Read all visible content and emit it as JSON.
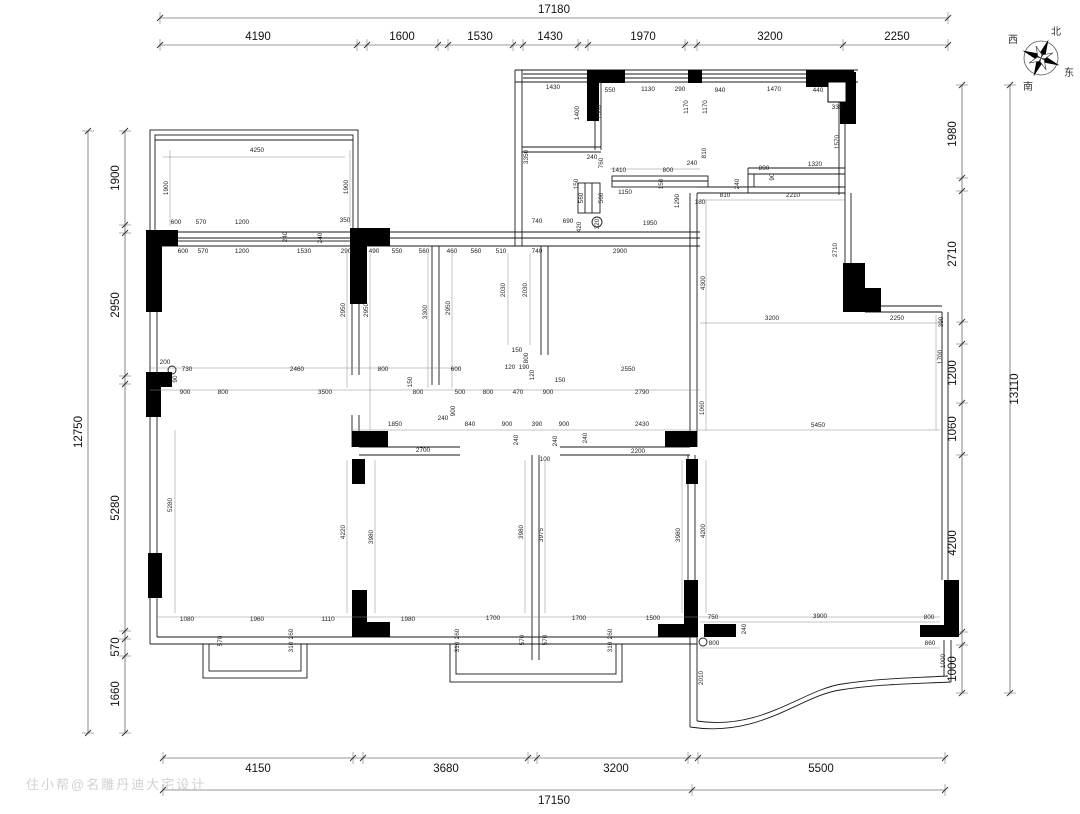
{
  "watermark": "住小帮@名雕丹迪大宅设计",
  "compass": {
    "north": "北",
    "south": "南",
    "east": "东",
    "west": "西"
  },
  "colors": {
    "wall": "#1a1a1a",
    "dim": "#333333",
    "thin": "#888888",
    "watermark": "#c9c9c9"
  },
  "dim_chains": [
    {
      "name": "top-total",
      "dir": "h",
      "y": 18,
      "ticks": [
        160,
        948
      ],
      "label_dy": -5,
      "labels": [
        {
          "p": 554,
          "t": "17180"
        }
      ]
    },
    {
      "name": "top-segments",
      "dir": "h",
      "y": 45,
      "ticks": [
        160,
        357,
        367,
        438,
        448,
        513,
        523,
        578,
        588,
        685,
        697,
        843,
        948
      ],
      "label_dy": -5,
      "labels": [
        {
          "p": 258,
          "t": "4190"
        },
        {
          "p": 402,
          "t": "1600"
        },
        {
          "p": 480,
          "t": "1530"
        },
        {
          "p": 550,
          "t": "1430"
        },
        {
          "p": 643,
          "t": "1970"
        },
        {
          "p": 770,
          "t": "3200"
        },
        {
          "p": 897,
          "t": "2250"
        }
      ]
    },
    {
      "name": "bottom-segments",
      "dir": "h",
      "y": 758,
      "ticks": [
        163,
        353,
        363,
        528,
        537,
        688,
        698,
        945
      ],
      "label_dy": 14,
      "labels": [
        {
          "p": 258,
          "t": "4150"
        },
        {
          "p": 446,
          "t": "3680"
        },
        {
          "p": 616,
          "t": "3200"
        },
        {
          "p": 821,
          "t": "5500"
        }
      ]
    },
    {
      "name": "bottom-total",
      "dir": "h",
      "y": 790,
      "ticks": [
        163,
        692,
        945
      ],
      "label_dy": 14,
      "labels": [
        {
          "p": 554,
          "t": "17150"
        }
      ]
    },
    {
      "name": "left-total",
      "dir": "v",
      "x": 88,
      "ticks": [
        131,
        733
      ],
      "label_dx": -6,
      "labels": [
        {
          "p": 432,
          "t": "12750"
        }
      ]
    },
    {
      "name": "left-segments",
      "dir": "v",
      "x": 125,
      "ticks": [
        131,
        225,
        233,
        376,
        384,
        631,
        639,
        656,
        733
      ],
      "label_dx": -6,
      "labels": [
        {
          "p": 178,
          "t": "1900"
        },
        {
          "p": 305,
          "t": "2950"
        },
        {
          "p": 508,
          "t": "5280"
        },
        {
          "p": 647,
          "t": "570"
        },
        {
          "p": 694,
          "t": "1660"
        }
      ]
    },
    {
      "name": "right-segments",
      "dir": "v",
      "x": 962,
      "ticks": [
        85,
        178,
        191,
        322,
        344,
        403,
        455,
        632,
        645,
        693
      ],
      "label_dx": -6,
      "labels": [
        {
          "p": 134,
          "t": "1980"
        },
        {
          "p": 254,
          "t": "2710"
        },
        {
          "p": 373,
          "t": "1200"
        },
        {
          "p": 429,
          "t": "1060"
        },
        {
          "p": 543,
          "t": "4200"
        },
        {
          "p": 669,
          "t": "1000"
        }
      ]
    },
    {
      "name": "right-total",
      "dir": "v",
      "x": 1010,
      "ticks": [
        85,
        693
      ],
      "label_dx": 8,
      "labels": [
        {
          "p": 389,
          "t": "13110"
        }
      ]
    }
  ],
  "annotations": [
    {
      "x": 257,
      "y": 152,
      "t": "4250"
    },
    {
      "x": 168,
      "y": 188,
      "t": "1900",
      "r": 1
    },
    {
      "x": 348,
      "y": 187,
      "t": "1900",
      "r": 1
    },
    {
      "x": 176,
      "y": 224,
      "t": "600"
    },
    {
      "x": 201,
      "y": 224,
      "t": "570"
    },
    {
      "x": 242,
      "y": 224,
      "t": "1200"
    },
    {
      "x": 345,
      "y": 222,
      "t": "350"
    },
    {
      "x": 287,
      "y": 237,
      "t": "240",
      "r": 1
    },
    {
      "x": 322,
      "y": 238,
      "t": "240",
      "r": 1
    },
    {
      "x": 183,
      "y": 253,
      "t": "600"
    },
    {
      "x": 203,
      "y": 253,
      "t": "570"
    },
    {
      "x": 242,
      "y": 253,
      "t": "1200"
    },
    {
      "x": 304,
      "y": 253,
      "t": "1530"
    },
    {
      "x": 346,
      "y": 253,
      "t": "290"
    },
    {
      "x": 374,
      "y": 253,
      "t": "490"
    },
    {
      "x": 397,
      "y": 253,
      "t": "550"
    },
    {
      "x": 424,
      "y": 253,
      "t": "560"
    },
    {
      "x": 452,
      "y": 253,
      "t": "460"
    },
    {
      "x": 476,
      "y": 253,
      "t": "560"
    },
    {
      "x": 501,
      "y": 253,
      "t": "510"
    },
    {
      "x": 537,
      "y": 253,
      "t": "740"
    },
    {
      "x": 620,
      "y": 253,
      "t": "2900"
    },
    {
      "x": 537,
      "y": 223,
      "t": "740"
    },
    {
      "x": 568,
      "y": 223,
      "t": "690"
    },
    {
      "x": 581,
      "y": 227,
      "t": "420",
      "r": 1
    },
    {
      "x": 599,
      "y": 224,
      "t": "320",
      "r": 1
    },
    {
      "x": 650,
      "y": 225,
      "t": "1950"
    },
    {
      "x": 345,
      "y": 310,
      "t": "2950",
      "r": 1
    },
    {
      "x": 368,
      "y": 310,
      "t": "2950",
      "r": 1
    },
    {
      "x": 427,
      "y": 312,
      "t": "3300",
      "r": 1
    },
    {
      "x": 450,
      "y": 308,
      "t": "2950",
      "r": 1
    },
    {
      "x": 505,
      "y": 290,
      "t": "2030",
      "r": 1
    },
    {
      "x": 527,
      "y": 290,
      "t": "2030",
      "r": 1
    },
    {
      "x": 165,
      "y": 364,
      "t": "200"
    },
    {
      "x": 187,
      "y": 371,
      "t": "730"
    },
    {
      "x": 177,
      "y": 379,
      "t": "90",
      "r": 1
    },
    {
      "x": 297,
      "y": 371,
      "t": "2460"
    },
    {
      "x": 383,
      "y": 371,
      "t": "800"
    },
    {
      "x": 412,
      "y": 382,
      "t": "150",
      "r": 1
    },
    {
      "x": 456,
      "y": 371,
      "t": "600"
    },
    {
      "x": 517,
      "y": 352,
      "t": "150"
    },
    {
      "x": 528,
      "y": 358,
      "t": "800",
      "r": 1
    },
    {
      "x": 510,
      "y": 369,
      "t": "120"
    },
    {
      "x": 524,
      "y": 369,
      "t": "190"
    },
    {
      "x": 534,
      "y": 375,
      "t": "120",
      "r": 1
    },
    {
      "x": 560,
      "y": 382,
      "t": "150"
    },
    {
      "x": 628,
      "y": 371,
      "t": "2550"
    },
    {
      "x": 185,
      "y": 394,
      "t": "900"
    },
    {
      "x": 223,
      "y": 394,
      "t": "800"
    },
    {
      "x": 325,
      "y": 394,
      "t": "3500"
    },
    {
      "x": 418,
      "y": 394,
      "t": "800"
    },
    {
      "x": 460,
      "y": 394,
      "t": "500"
    },
    {
      "x": 488,
      "y": 394,
      "t": "800"
    },
    {
      "x": 518,
      "y": 394,
      "t": "470"
    },
    {
      "x": 548,
      "y": 394,
      "t": "900"
    },
    {
      "x": 642,
      "y": 394,
      "t": "2790"
    },
    {
      "x": 455,
      "y": 411,
      "t": "900",
      "r": 1
    },
    {
      "x": 704,
      "y": 408,
      "t": "1060",
      "r": 1
    },
    {
      "x": 395,
      "y": 426,
      "t": "1850"
    },
    {
      "x": 443,
      "y": 420,
      "t": "240"
    },
    {
      "x": 470,
      "y": 426,
      "t": "840"
    },
    {
      "x": 507,
      "y": 426,
      "t": "900"
    },
    {
      "x": 537,
      "y": 426,
      "t": "390"
    },
    {
      "x": 564,
      "y": 426,
      "t": "900"
    },
    {
      "x": 642,
      "y": 426,
      "t": "2430"
    },
    {
      "x": 818,
      "y": 427,
      "t": "5450"
    },
    {
      "x": 518,
      "y": 440,
      "t": "240",
      "r": 1
    },
    {
      "x": 557,
      "y": 441,
      "t": "240",
      "r": 1
    },
    {
      "x": 587,
      "y": 438,
      "t": "240",
      "r": 1
    },
    {
      "x": 423,
      "y": 452,
      "t": "2700"
    },
    {
      "x": 545,
      "y": 461,
      "t": "100"
    },
    {
      "x": 638,
      "y": 453,
      "t": "2200"
    },
    {
      "x": 172,
      "y": 505,
      "t": "5280",
      "r": 1
    },
    {
      "x": 345,
      "y": 532,
      "t": "4220",
      "r": 1
    },
    {
      "x": 373,
      "y": 537,
      "t": "3980",
      "r": 1
    },
    {
      "x": 523,
      "y": 532,
      "t": "3980",
      "r": 1
    },
    {
      "x": 543,
      "y": 535,
      "t": "3975",
      "r": 1
    },
    {
      "x": 680,
      "y": 535,
      "t": "3980",
      "r": 1
    },
    {
      "x": 705,
      "y": 531,
      "t": "4200",
      "r": 1
    },
    {
      "x": 187,
      "y": 621,
      "t": "1080"
    },
    {
      "x": 257,
      "y": 621,
      "t": "1960"
    },
    {
      "x": 328,
      "y": 621,
      "t": "1110"
    },
    {
      "x": 408,
      "y": 621,
      "t": "1980"
    },
    {
      "x": 493,
      "y": 620,
      "t": "1700"
    },
    {
      "x": 579,
      "y": 620,
      "t": "1700"
    },
    {
      "x": 653,
      "y": 620,
      "t": "1500"
    },
    {
      "x": 713,
      "y": 619,
      "t": "750"
    },
    {
      "x": 820,
      "y": 618,
      "t": "3900"
    },
    {
      "x": 929,
      "y": 619,
      "t": "800"
    },
    {
      "x": 222,
      "y": 641,
      "t": "570",
      "r": 1
    },
    {
      "x": 293,
      "y": 634,
      "t": "260",
      "r": 1
    },
    {
      "x": 293,
      "y": 647,
      "t": "310",
      "r": 1
    },
    {
      "x": 459,
      "y": 634,
      "t": "260",
      "r": 1
    },
    {
      "x": 459,
      "y": 647,
      "t": "310",
      "r": 1
    },
    {
      "x": 524,
      "y": 640,
      "t": "570",
      "r": 1
    },
    {
      "x": 547,
      "y": 640,
      "t": "570",
      "r": 1
    },
    {
      "x": 612,
      "y": 634,
      "t": "260",
      "r": 1
    },
    {
      "x": 612,
      "y": 647,
      "t": "310",
      "r": 1
    },
    {
      "x": 746,
      "y": 629,
      "t": "240",
      "r": 1
    },
    {
      "x": 714,
      "y": 645,
      "t": "800"
    },
    {
      "x": 930,
      "y": 645,
      "t": "860"
    },
    {
      "x": 945,
      "y": 661,
      "t": "1000",
      "r": 1
    },
    {
      "x": 703,
      "y": 678,
      "t": "2010",
      "r": 1
    },
    {
      "x": 772,
      "y": 320,
      "t": "3200"
    },
    {
      "x": 897,
      "y": 320,
      "t": "2250"
    },
    {
      "x": 943,
      "y": 322,
      "t": "390",
      "r": 1
    },
    {
      "x": 942,
      "y": 357,
      "t": "1700",
      "r": 1
    },
    {
      "x": 705,
      "y": 283,
      "t": "4300",
      "r": 1
    },
    {
      "x": 837,
      "y": 250,
      "t": "2710",
      "r": 1
    },
    {
      "x": 553,
      "y": 89,
      "t": "1430"
    },
    {
      "x": 610,
      "y": 92,
      "t": "550"
    },
    {
      "x": 648,
      "y": 91,
      "t": "1130"
    },
    {
      "x": 680,
      "y": 91,
      "t": "290"
    },
    {
      "x": 579,
      "y": 113,
      "t": "1400",
      "r": 1
    },
    {
      "x": 601,
      "y": 112,
      "t": "1360",
      "r": 1
    },
    {
      "x": 688,
      "y": 107,
      "t": "1170",
      "r": 1
    },
    {
      "x": 707,
      "y": 107,
      "t": "1170",
      "r": 1
    },
    {
      "x": 528,
      "y": 157,
      "t": "3350",
      "r": 1
    },
    {
      "x": 592,
      "y": 159,
      "t": "240"
    },
    {
      "x": 603,
      "y": 163,
      "t": "760",
      "r": 1
    },
    {
      "x": 619,
      "y": 172,
      "t": "1410"
    },
    {
      "x": 668,
      "y": 172,
      "t": "800"
    },
    {
      "x": 692,
      "y": 165,
      "t": "240"
    },
    {
      "x": 578,
      "y": 184,
      "t": "150",
      "r": 1
    },
    {
      "x": 663,
      "y": 184,
      "t": "150",
      "r": 1
    },
    {
      "x": 625,
      "y": 194,
      "t": "1150"
    },
    {
      "x": 583,
      "y": 198,
      "t": "560",
      "r": 1
    },
    {
      "x": 603,
      "y": 198,
      "t": "560",
      "r": 1
    },
    {
      "x": 706,
      "y": 153,
      "t": "810",
      "r": 1
    },
    {
      "x": 679,
      "y": 201,
      "t": "1290",
      "r": 1
    },
    {
      "x": 700,
      "y": 204,
      "t": "180"
    },
    {
      "x": 720,
      "y": 92,
      "t": "940"
    },
    {
      "x": 774,
      "y": 91,
      "t": "1470"
    },
    {
      "x": 818,
      "y": 92,
      "t": "440"
    },
    {
      "x": 837,
      "y": 109,
      "t": "330"
    },
    {
      "x": 839,
      "y": 142,
      "t": "1570",
      "r": 1
    },
    {
      "x": 764,
      "y": 170,
      "t": "890"
    },
    {
      "x": 774,
      "y": 177,
      "t": "90",
      "r": 1
    },
    {
      "x": 815,
      "y": 166,
      "t": "1320"
    },
    {
      "x": 739,
      "y": 184,
      "t": "240",
      "r": 1
    },
    {
      "x": 725,
      "y": 197,
      "t": "810"
    },
    {
      "x": 793,
      "y": 197,
      "t": "2210"
    }
  ]
}
